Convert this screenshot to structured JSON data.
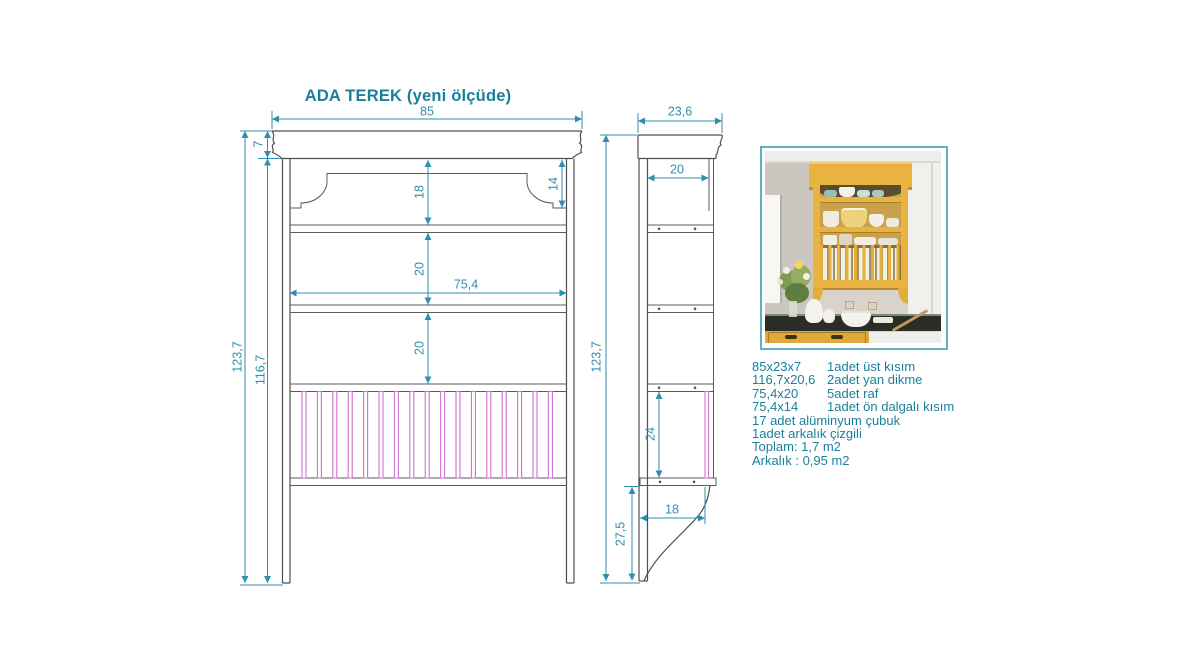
{
  "title": "ADA TEREK (yeni ölçüde)",
  "front_view": {
    "dims": {
      "width": "85",
      "cornice_height": "7",
      "total_height": "123,7",
      "side_height": "116,7",
      "top_section_height": "18",
      "valance_edge_height": "14",
      "shelf_gap_upper": "20",
      "inner_width": "75,4",
      "shelf_gap_lower": "20"
    },
    "rod_count": 17
  },
  "side_view": {
    "dims": {
      "depth": "23,6",
      "inner_depth": "20",
      "total_height": "123,7",
      "rod_section_height": "24",
      "bracket_depth": "18",
      "leg_height": "27,5"
    }
  },
  "parts_list": {
    "rows": [
      {
        "size": "85x23x7",
        "qty_desc": "1adet üst kısım"
      },
      {
        "size": "116,7x20,6",
        "qty_desc": "2adet yan dikme"
      },
      {
        "size": "75,4x20",
        "qty_desc": "5adet raf"
      },
      {
        "size": "75,4x14",
        "qty_desc": "1adet ön dalgalı kısım"
      }
    ],
    "notes": [
      "17 adet alüminyum çubuk",
      "1adet arkalık çizgili"
    ],
    "totals": [
      "Toplam: 1,7 m2",
      "Arkalık : 0,95 m2"
    ]
  },
  "colors": {
    "teal_text": "#1b7f9b",
    "dimension": "#2f8fad",
    "drawing_line": "#4f4f4f",
    "rod_pink": "#cf74cf",
    "photo_border": "#5db0c2",
    "hutch_yellow": "#e8b341"
  }
}
